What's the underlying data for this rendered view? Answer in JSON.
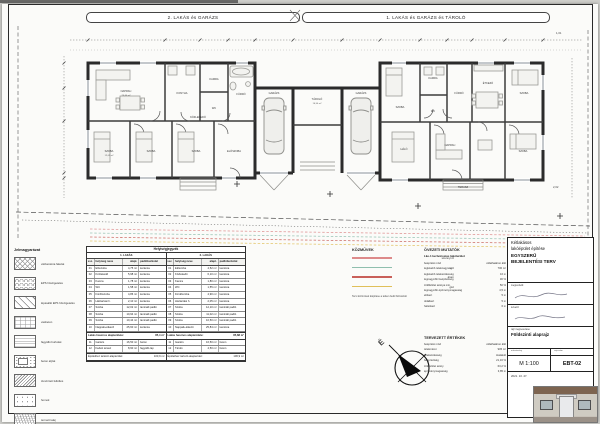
{
  "sheet": {
    "headers": {
      "left": "2. LAKÁS és GARÁZS",
      "right": "1. LAKÁS és GARÁZS és TÁROLÓ"
    },
    "annotations": {
      "dim_right_top": "1,01",
      "dim_right_mid": "2,02"
    }
  },
  "plan": {
    "rooms": {
      "nappali": "NAPPALI",
      "konyha": "KONYHA",
      "kamra": "KAMRA",
      "wc": "WC",
      "furdo": "FÜRDŐ",
      "szoba": "SZOBA",
      "eloszoba": "ELŐSZOBA",
      "kozlekedo": "KÖZLEKEDŐ",
      "garazs": "GARÁZS",
      "tarolo": "TÁROLÓ",
      "terasz": "TERASZ",
      "halo": "HÁLÓ",
      "etkezo": "ÉTKEZŐ"
    },
    "areas": {
      "nappali": "25,60 m²",
      "szoba": "12,02 m²",
      "garazs": "16,50 m²"
    }
  },
  "legend": {
    "title": "Jelmagyarázat",
    "items": [
      {
        "pattern": "diamond",
        "label": "vázkerámia falazat"
      },
      {
        "pattern": "scallop",
        "label": "EPS hőszigetelés"
      },
      {
        "pattern": "diag",
        "label": "lépésálló EPS hőszigetelés"
      },
      {
        "pattern": "grid",
        "label": "vasbeton"
      },
      {
        "pattern": "hlines",
        "label": "fagyálló burkolat"
      },
      {
        "pattern": "speckle",
        "label": "beton aljzat"
      },
      {
        "pattern": "dense",
        "label": "tömörített feltöltés"
      },
      {
        "pattern": "dots",
        "label": "homok"
      },
      {
        "pattern": "soil",
        "label": "termett talaj"
      }
    ]
  },
  "schedule": {
    "title": "Helyiségjegyzék",
    "cols": {
      "no": "ssz.",
      "name": "helyiség neve",
      "area": "alapt.",
      "floor": "padlóburkolat"
    },
    "halves": [
      {
        "title": "1. LAKÁS",
        "rows": [
          {
            "no": "01",
            "name": "Előszoba",
            "area": "4,75 m²",
            "floor": "kerámia"
          },
          {
            "no": "02",
            "name": "Közlekedő",
            "area": "5,98 m²",
            "floor": "kerámia"
          },
          {
            "no": "03",
            "name": "Kamra",
            "area": "1,78 m²",
            "floor": "kerámia"
          },
          {
            "no": "04",
            "name": "WC",
            "area": "1,58 m²",
            "floor": "kerámia"
          },
          {
            "no": "05",
            "name": "Fürdőszoba",
            "area": "4,86 m²",
            "floor": "kerámia"
          },
          {
            "no": "06",
            "name": "Háztartási h.",
            "area": "2,10 m²",
            "floor": "kerámia"
          },
          {
            "no": "07",
            "name": "Szoba",
            "area": "12,02 m²",
            "floor": "laminált padló"
          },
          {
            "no": "08",
            "name": "Szoba",
            "area": "10,94 m²",
            "floor": "laminált padló"
          },
          {
            "no": "09",
            "name": "Szoba",
            "area": "10,44 m²",
            "floor": "laminált padló"
          },
          {
            "no": "10",
            "name": "Nappali+étkező",
            "area": "25,60 m²",
            "floor": "kerámia"
          }
        ],
        "sum_label": "Lakás hasznos alapterülete:",
        "sum_value": "85,4 m²",
        "extras": [
          {
            "no": "11",
            "name": "Garázs",
            "area": "16,50 m²",
            "floor": "beton"
          },
          {
            "no": "12",
            "name": "Fedett terasz",
            "area": "8,90 m²",
            "floor": "fagyálló lap"
          }
        ],
        "total_label": "Épülethez tartozó alapterület:",
        "total_value": "103,9 m²"
      },
      {
        "title": "2. LAKÁS",
        "rows": [
          {
            "no": "01",
            "name": "Előszoba",
            "area": "4,52 m²",
            "floor": "kerámia"
          },
          {
            "no": "02",
            "name": "Közlekedő",
            "area": "6,10 m²",
            "floor": "kerámia"
          },
          {
            "no": "03",
            "name": "Kamra",
            "area": "1,80 m²",
            "floor": "kerámia"
          },
          {
            "no": "04",
            "name": "WC",
            "area": "1,55 m²",
            "floor": "kerámia"
          },
          {
            "no": "05",
            "name": "Fürdőszoba",
            "area": "4,90 m²",
            "floor": "kerámia"
          },
          {
            "no": "06",
            "name": "Háztartási h.",
            "area": "2,05 m²",
            "floor": "kerámia"
          },
          {
            "no": "07",
            "name": "Szoba",
            "area": "12,10 m²",
            "floor": "laminált padló"
          },
          {
            "no": "08",
            "name": "Szoba",
            "area": "11,02 m²",
            "floor": "laminált padló"
          },
          {
            "no": "09",
            "name": "Szoba",
            "area": "10,50 m²",
            "floor": "laminált padló"
          },
          {
            "no": "10",
            "name": "Nappali+étkező",
            "area": "25,84 m²",
            "floor": "kerámia"
          }
        ],
        "sum_label": "Lakás hasznos alapterülete:",
        "sum_value": "85,88 m²",
        "extras": [
          {
            "no": "11",
            "name": "Garázs",
            "area": "16,50 m²",
            "floor": "beton"
          },
          {
            "no": "12",
            "name": "Tároló",
            "area": "4,50 m²",
            "floor": "beton"
          }
        ],
        "total_label": "Épülethez tartozó alapterület:",
        "total_value": "106,9 m²"
      }
    ]
  },
  "utilities": {
    "title": "KÖZMŰVEK",
    "items": [
      {
        "color": "#dd8a8a",
        "label": "szennyvíz"
      },
      {
        "color": "#8fbfae",
        "label": "víz"
      },
      {
        "color": "#c9605a",
        "label": "áram"
      },
      {
        "color": "#e0c05a",
        "label": "gáz"
      }
    ],
    "note": "Tervi közművek kiépítése a telken belül biztosított"
  },
  "zoning": {
    "title": "ÖVEZETI MUTATÓK",
    "subtitle": "Lke-1 kertvárosias lakóterület",
    "rows": [
      {
        "k": "beépítési mód",
        "v": "oldalhatáron álló"
      },
      {
        "k": "legkisebb teleknagyság",
        "v": "700 m²"
      },
      {
        "k": "legkisebb telekszélesség",
        "v": "16 m"
      },
      {
        "k": "legnagyobb beépítettség",
        "v": "30 %"
      },
      {
        "k": "zöldfelület aránya min.",
        "v": "50 %"
      },
      {
        "k": "legnagyobb építménymagasság",
        "v": "4,5 m"
      },
      {
        "k": "előkert",
        "v": "5 m"
      },
      {
        "k": "oldalkert",
        "v": "5 m"
      },
      {
        "k": "hátsókert",
        "v": "6 m"
      }
    ]
  },
  "planned": {
    "title": "TERVEZETT ÉRTÉKEK",
    "rows": [
      {
        "k": "beépítési mód",
        "v": "oldalhatáron álló"
      },
      {
        "k": "telekméret",
        "v": "905 m²"
      },
      {
        "k": "telekszélesség",
        "v": "kialakult"
      },
      {
        "k": "beépítettség",
        "v": "21,16 %"
      },
      {
        "k": "zöldfelület arány",
        "v": "63,2 %"
      },
      {
        "k": "építménymagasság",
        "v": "3,85 m"
      }
    ]
  },
  "north": {
    "label": "É"
  },
  "titleblock": {
    "project_line1": "Kétlakásos",
    "project_line2": "lakóépület építése",
    "type_line1": "EGYSZERŰ",
    "type_line2": "BEJELENTÉSI TERV",
    "client_label": "megrendelő:",
    "designer_label": "tervező:",
    "drawing_label": "rajz megnevezése:",
    "drawing_title": "Földszinti alaprajz",
    "scale_caption": "méretarány",
    "number_caption": "rajzszám",
    "scale": "M 1:100",
    "sheet_no": "EBT-02",
    "date": "2021. 10. 27."
  }
}
